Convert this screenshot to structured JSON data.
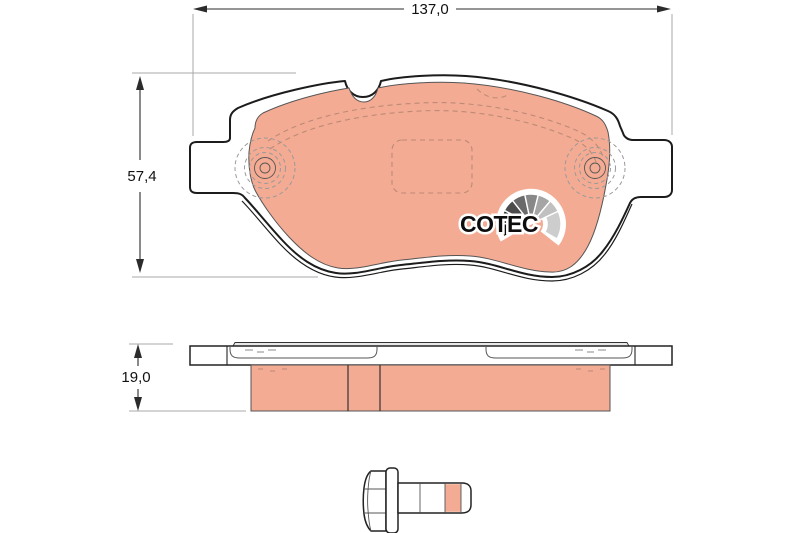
{
  "drawing": {
    "title": "Brake pad technical drawing",
    "logo_text": "COTEC"
  },
  "dimensions": {
    "width_mm": "137,0",
    "height_mm": "57,4",
    "thickness_mm": "19,0"
  },
  "colors": {
    "background": "#ffffff",
    "friction_material": "#f4ab93",
    "outline": "#1c1c1c",
    "thin_line": "#555555",
    "hidden_detail_dash": "#bc8a76",
    "dimension_line": "#2b2b2b",
    "extension_line": "#a9a9a9",
    "dimension_text": "#111111",
    "logo_text_color": "#0d0d0d",
    "logo_fan_grays": [
      "#0a0a0a",
      "#2d2d2d",
      "#4c4c4c",
      "#6a6a6a",
      "#888888",
      "#a5a5a5",
      "#c0c0c0",
      "#cdcdcd"
    ]
  }
}
